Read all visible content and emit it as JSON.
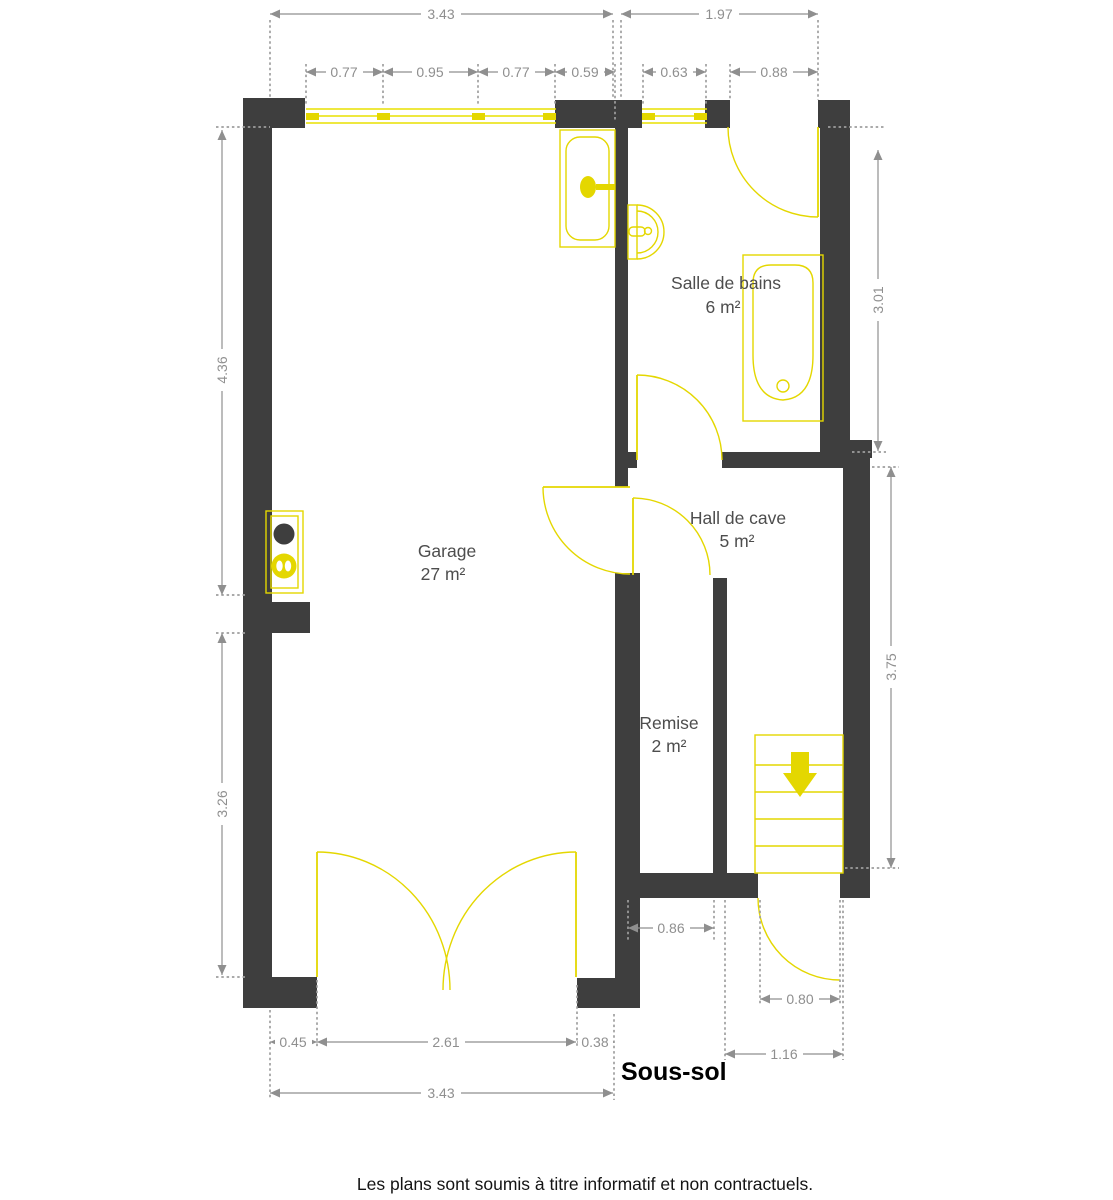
{
  "meta": {
    "plan_title": "Sous-sol",
    "disclaimer": "Les plans sont soumis à titre informatif et non contractuels."
  },
  "colors": {
    "wall": "#3e3e3e",
    "fixture_yellow": "#e4d700",
    "dimension_gray": "#8f8f8f",
    "room_label_gray": "#4d4d4d",
    "background": "#ffffff"
  },
  "rooms": {
    "garage": {
      "name": "Garage",
      "area": "27 m²"
    },
    "bathroom": {
      "name": "Salle de bains",
      "area": "6 m²"
    },
    "hall": {
      "name": "Hall de cave",
      "area": "5 m²"
    },
    "storage": {
      "name": "Remise",
      "area": "2 m²"
    }
  },
  "dims": {
    "top_left_total": "3.43",
    "top_right_total": "1.97",
    "win_a": "0.77",
    "win_b": "0.95",
    "win_c": "0.77",
    "pier": "0.59",
    "bath_window": "0.63",
    "bath_door": "0.88",
    "left_upper": "4.36",
    "left_lower": "3.26",
    "right_upper": "3.01",
    "right_lower": "3.75",
    "bottom_a": "0.45",
    "bottom_b": "2.61",
    "bottom_c": "0.38",
    "bottom_total": "3.43",
    "storage_width": "0.86",
    "exit_door": "0.80",
    "exit_total": "1.16"
  },
  "icons": {
    "stairs_direction": "down-arrow",
    "boiler": "flame"
  }
}
